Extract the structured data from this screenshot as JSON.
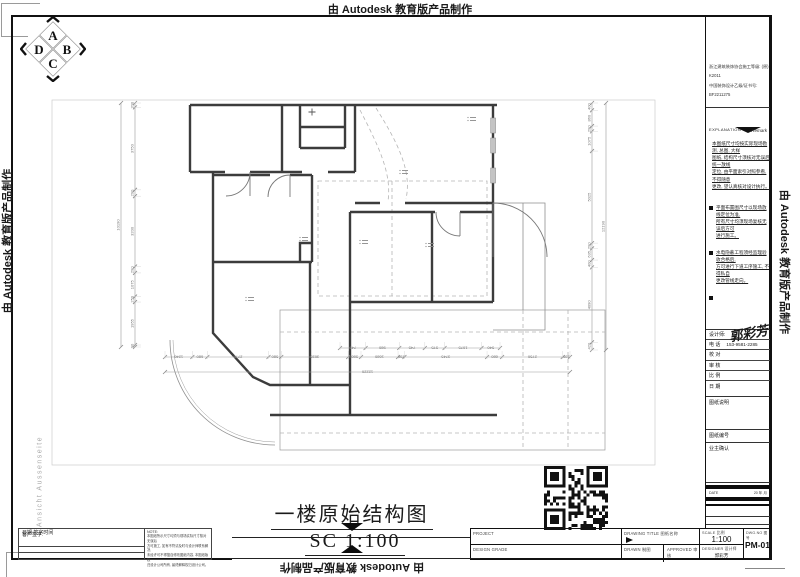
{
  "autodesk_banner": "由 Autodesk 教育版产品制作",
  "side_note": "Ansicht Aussenseite",
  "logo": {
    "top": "A",
    "right": "B",
    "bottom": "C",
    "left": "D"
  },
  "title": {
    "text": "一楼原始结构图",
    "scale": "SC 1:100"
  },
  "sidebar": {
    "certificates": [
      "浙江建筑装饰协会施工等级: (原) K2011",
      "中国装饰设计乙级/证书号: BF2211275"
    ],
    "explanation": {
      "en": "EXPLANATION",
      "cn": "Remark",
      "intro": "本图纸尺寸均按实际现场勘测, 总图, 大样\n图纸, 结构尺寸须核对无误后统一放线\n定位, 由平面索引对照参看, 不得随意\n更改, 望认真核对设计执行。",
      "bullets": [
        "平面布置图尺寸以现场放线定位为准,\n所有尺寸均须现场复核无误后方可\n进行施工。",
        "水电隐蔽工程须经监理验收合格后,\n方可进行下道工序施工, 不得私自\n更改管线走向。"
      ]
    },
    "fields": {
      "designer": "设计师:",
      "signature": "郭彩芳",
      "phone_label": "电  话",
      "phone": "153-9581-2285",
      "check": "校  对",
      "review": "审  核",
      "scale": "比  例",
      "date": "日  期"
    },
    "notes_label": "图纸说明",
    "no_label": "图纸编号",
    "owner_label": "业主确认",
    "date_row": {
      "label": "DATE",
      "value": "20    年    月"
    }
  },
  "titleblock": {
    "project_label": "PROJECT",
    "design_grade_label": "DESIGN  GRADE",
    "drawing_title_label": "DRAWING  TITLE  图纸名称",
    "drawn_label": "DRAWN  制图",
    "approved_label": "APPROVED  审核",
    "scale_label": "SCALE  比例",
    "scale_value": "1:100",
    "designer_label": "DESIGNER  设计师",
    "designer_value": "郭彩芳",
    "dwg_label": "DWG.NO  图号",
    "dwg_value": "PM-01"
  },
  "client": {
    "sign": "客户签字:",
    "date": "日期      签字时间",
    "note_title": "NOTE:",
    "note": "本图纸所示尺寸均须与现场实际尺寸核对无误后\n方可施工, 如有不符请及时与设计师联系解决,\n未经许可不得擅自修改图纸内容, 本图纸版权\n归设计公司所有, 最终解释权归设计公司。"
  },
  "dimensions": {
    "left": {
      "segments": [
        "200",
        "3750",
        "290",
        "3200",
        "290",
        "1075",
        "250",
        "1955",
        "90"
      ],
      "total": "10190"
    },
    "right": {
      "segments": [
        "400",
        "860",
        "290",
        "1075",
        "5025",
        "290",
        "635",
        "400",
        "4090",
        "420"
      ],
      "total": "12190"
    },
    "bottom": {
      "segments": [
        "1240",
        "680",
        "2770",
        "580",
        "3035",
        "580",
        "1680",
        "290",
        "3745",
        "680",
        "2750",
        "330"
      ],
      "total": "12220"
    },
    "bottom_sub": {
      "segments": [
        "745",
        "980",
        "745",
        "575",
        "1075",
        "540"
      ]
    }
  },
  "plan": {
    "room_tags": [
      [
        262,
        152
      ],
      [
        322,
        155
      ],
      [
        388,
        158
      ],
      [
        362,
        85
      ],
      [
        430,
        32
      ],
      [
        208,
        212
      ]
    ]
  }
}
